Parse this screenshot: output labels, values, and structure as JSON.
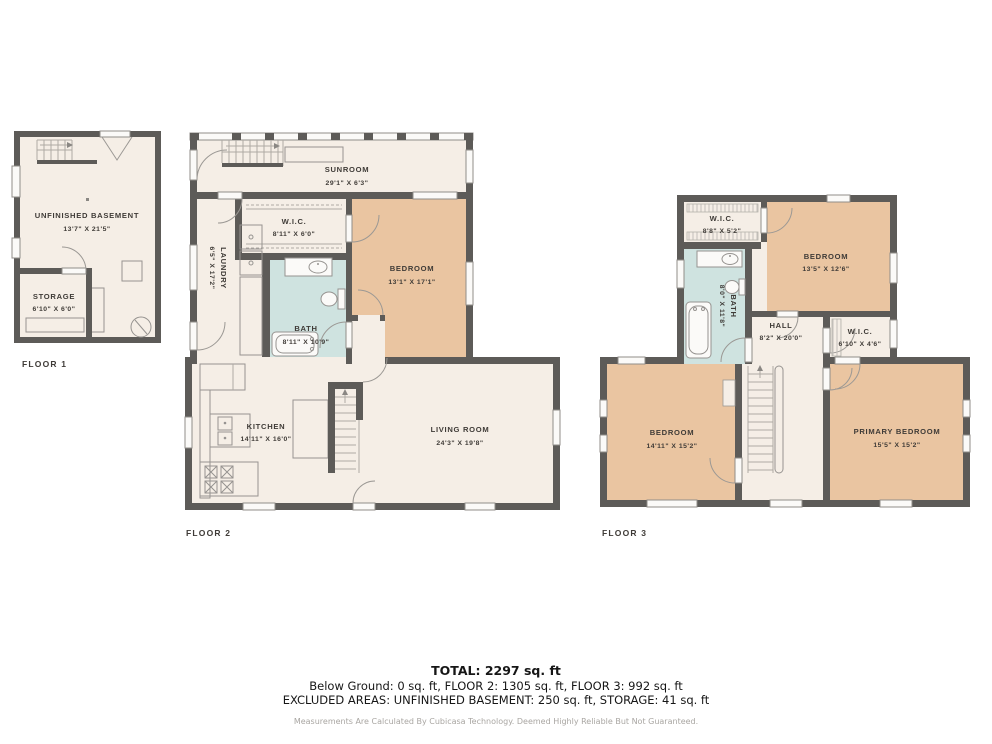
{
  "floors": [
    {
      "label": "FLOOR 1",
      "rooms": [
        {
          "name": "UNFINISHED BASEMENT",
          "dims": "13'7\" X 21'5\""
        },
        {
          "name": "STORAGE",
          "dims": "6'10\" X 6'0\""
        }
      ]
    },
    {
      "label": "FLOOR 2",
      "rooms": [
        {
          "name": "SUNROOM",
          "dims": "29'1\" X 6'3\""
        },
        {
          "name": "W.I.C.",
          "dims": "8'11\" X 6'0\""
        },
        {
          "name": "BEDROOM",
          "dims": "13'1\" X 17'1\""
        },
        {
          "name": "LAUNDRY",
          "dims": "6'5\" X 17'2\""
        },
        {
          "name": "BATH",
          "dims": "8'11\" X 10'9\""
        },
        {
          "name": "KITCHEN",
          "dims": "14'11\" X 16'0\""
        },
        {
          "name": "LIVING ROOM",
          "dims": "24'3\" X 19'8\""
        }
      ]
    },
    {
      "label": "FLOOR 3",
      "rooms": [
        {
          "name": "W.I.C.",
          "dims": "8'8\" X 5'2\""
        },
        {
          "name": "BEDROOM",
          "dims": "13'5\" X 12'6\""
        },
        {
          "name": "BATH",
          "dims": "8'0\" X 11'8\""
        },
        {
          "name": "HALL",
          "dims": "8'2\" X 20'0\""
        },
        {
          "name": "W.I.C.",
          "dims": "6'10\" X 4'6\""
        },
        {
          "name": "BEDROOM",
          "dims": "14'11\" X 15'2\""
        },
        {
          "name": "PRIMARY BEDROOM",
          "dims": "15'5\" X 15'2\""
        }
      ]
    }
  ],
  "summary": {
    "total": "TOTAL: 2297 sq. ft",
    "breakdown": "Below Ground: 0 sq. ft, FLOOR 2: 1305 sq. ft, FLOOR 3: 992 sq. ft",
    "excluded": "EXCLUDED AREAS: UNFINISHED BASEMENT: 250 sq. ft, STORAGE: 41 sq. ft",
    "disclaimer": "Measurements Are Calculated By Cubicasa Technology. Deemed Highly Reliable But Not Guaranteed."
  },
  "colors": {
    "wall": "#5d5b58",
    "floor": "#f5eee6",
    "bedroom_fill": "#eac5a1",
    "wet_room_fill": "#cfe3e0",
    "background": "#ffffff"
  }
}
